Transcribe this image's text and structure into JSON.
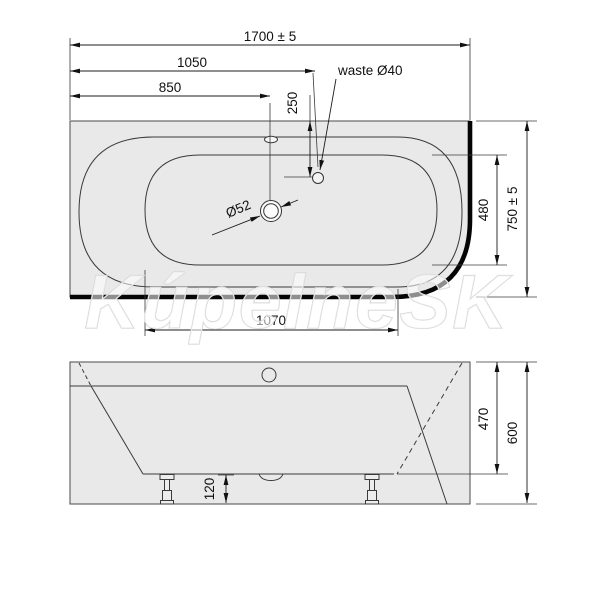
{
  "watermark": "KúpelneSK",
  "top_view": {
    "dim_overall_length": "1700 ± 5",
    "dim_1050": "1050",
    "dim_850": "850",
    "dim_250": "250",
    "waste_label": "waste Ø40",
    "drain_label": "Ø52",
    "dim_1070": "1070",
    "dim_480": "480",
    "dim_overall_width": "750 ± 5"
  },
  "side_view": {
    "dim_120": "120",
    "dim_470": "470",
    "dim_600": "600"
  }
}
